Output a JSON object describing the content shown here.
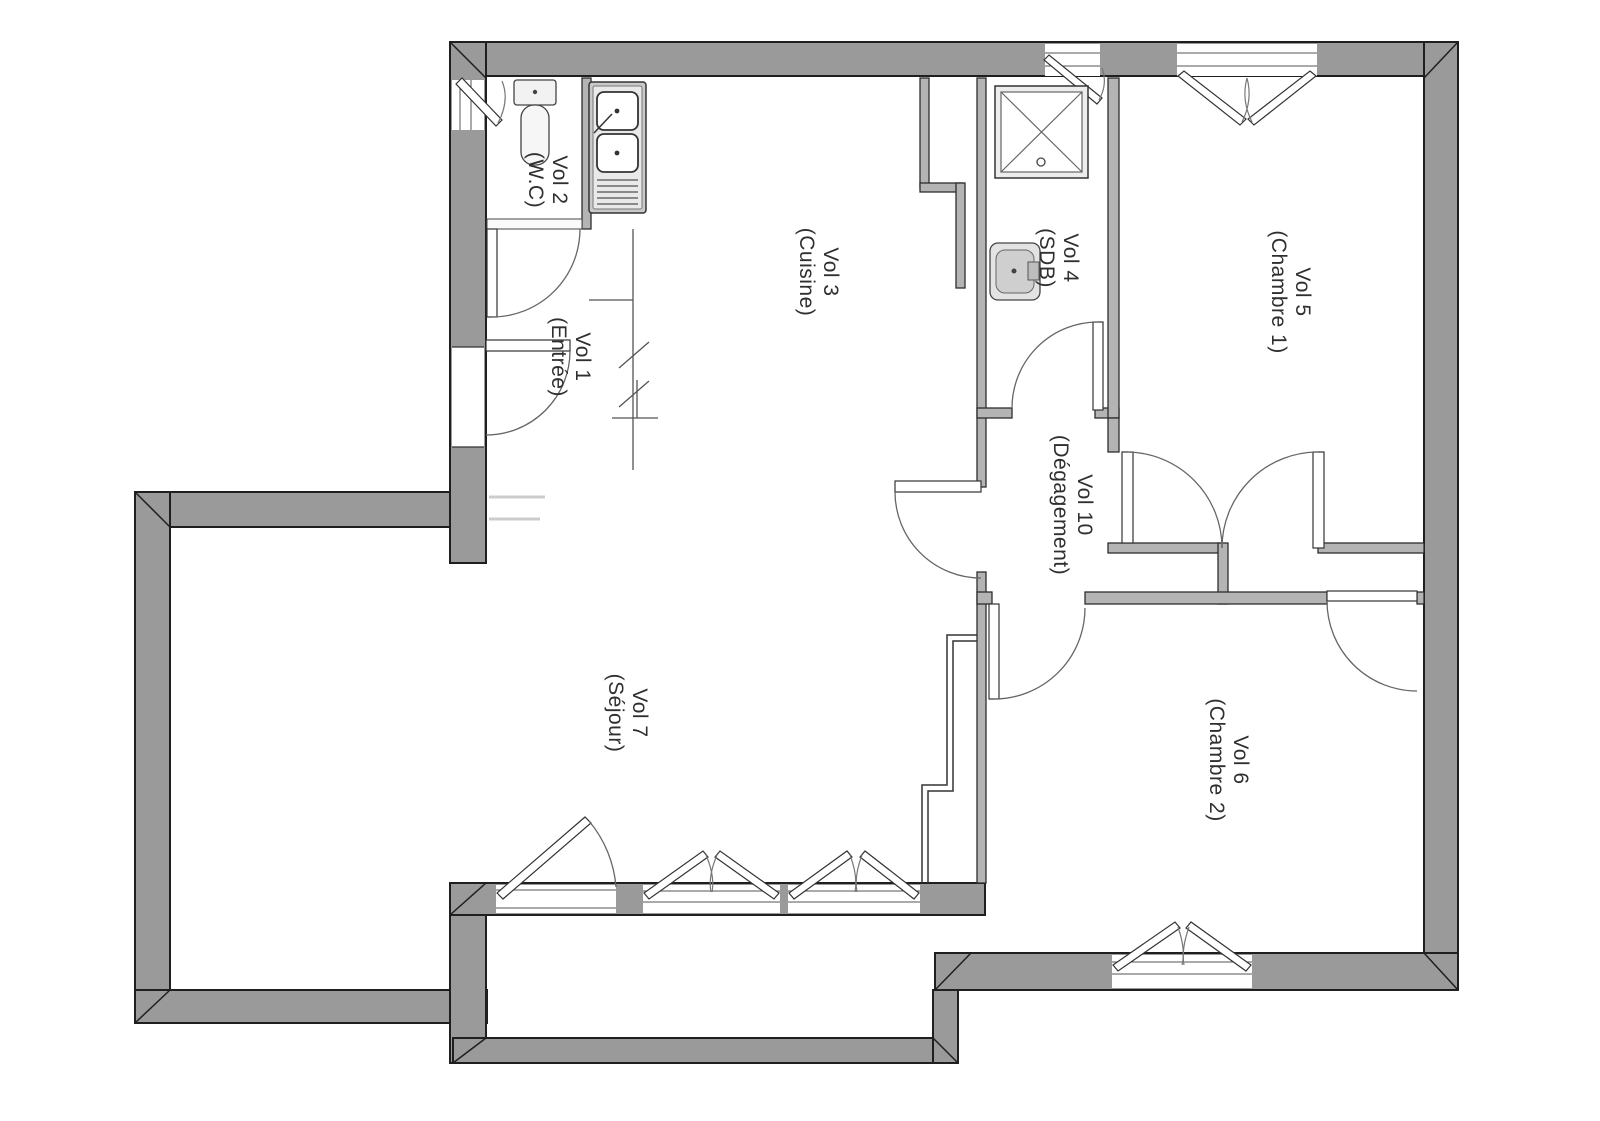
{
  "plan": {
    "type": "apartment-floor-plan",
    "language": "fr"
  },
  "rooms": [
    {
      "id": "wc",
      "label": "Vol 2",
      "sublabel": "(W.C)"
    },
    {
      "id": "entree",
      "label": "Vol 1",
      "sublabel": "(Entrée)"
    },
    {
      "id": "cuisine",
      "label": "Vol 3",
      "sublabel": "(Cuisine)"
    },
    {
      "id": "sdb",
      "label": "Vol 4",
      "sublabel": "(SDB)"
    },
    {
      "id": "chambre1",
      "label": "Vol 5",
      "sublabel": "(Chambre 1)"
    },
    {
      "id": "degagement",
      "label": "Vol 10",
      "sublabel": "(Dégagement)"
    },
    {
      "id": "sejour",
      "label": "Vol 7",
      "sublabel": "(Séjour)"
    },
    {
      "id": "chambre2",
      "label": "Vol 6",
      "sublabel": "(Chambre 2)"
    }
  ],
  "fixtures": [
    "toilet-fixture",
    "kitchen-sink-fixture",
    "shower-fixture",
    "washbasin-fixture"
  ],
  "colors": {
    "wall": "#9a9a9a",
    "wall_outline": "#1f1f1f",
    "partition": "#b4b4b4",
    "background": "#ffffff",
    "label_text": "#2f2f2f"
  }
}
